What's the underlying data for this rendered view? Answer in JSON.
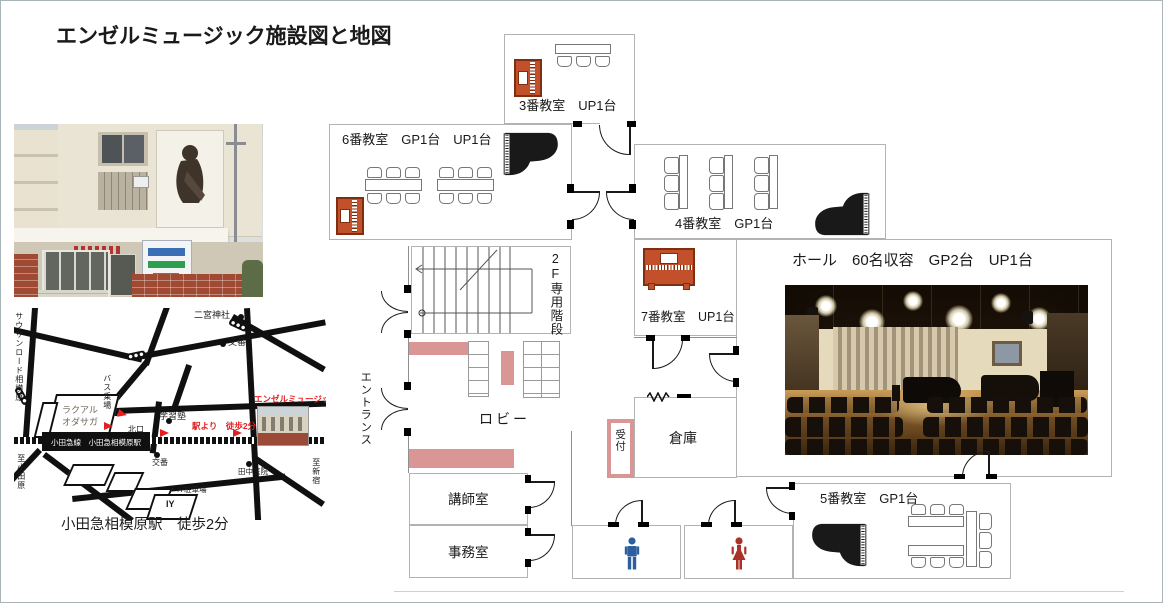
{
  "title": "エンゼルミュージック施設図と地図",
  "colors": {
    "piano_wood": "#c2512b",
    "accent_pink": "#d99694",
    "male_blue": "#2d5f9e",
    "female_red": "#a83228",
    "map_red": "#e51f1f"
  },
  "map": {
    "caption": "小田急相模原駅　徒歩2分",
    "labels": {
      "southern_road": "サウザンロード相模原",
      "ninomiya_shrine": "二宮神社",
      "police_box_north": "交番",
      "bus_stop": "バス乗場",
      "lacual_line1": "ラクアル",
      "lacual_line2": "オダサガ",
      "cram_school": "学習塾",
      "north_exit": "北口",
      "angel_music": "エンゼルミュージック",
      "walk_note": "駅より　徒歩2分",
      "station": "小田急線　小田急相模原駅",
      "to_odawara": "至小田原",
      "police_box_south": "交番",
      "tanaka_clinic": "田中医院",
      "iy_parking": "IY駐車場",
      "iy": "IY",
      "to_shinjuku": "至新宿"
    }
  },
  "floorplan": {
    "room3": "3番教室　UP1台",
    "room6": "6番教室　GP1台　UP1台",
    "room4": "4番教室　GP1台",
    "room7": "7番教室　UP1台",
    "room5": "5番教室　GP1台",
    "hall": "ホール　60名収容　GP2台　UP1台",
    "stairs": "2F専用階段",
    "lobby": "ロビー",
    "entrance": "エントランス",
    "reception": "受付",
    "storage": "倉庫",
    "teachers_room": "講師室",
    "office": "事務室"
  }
}
